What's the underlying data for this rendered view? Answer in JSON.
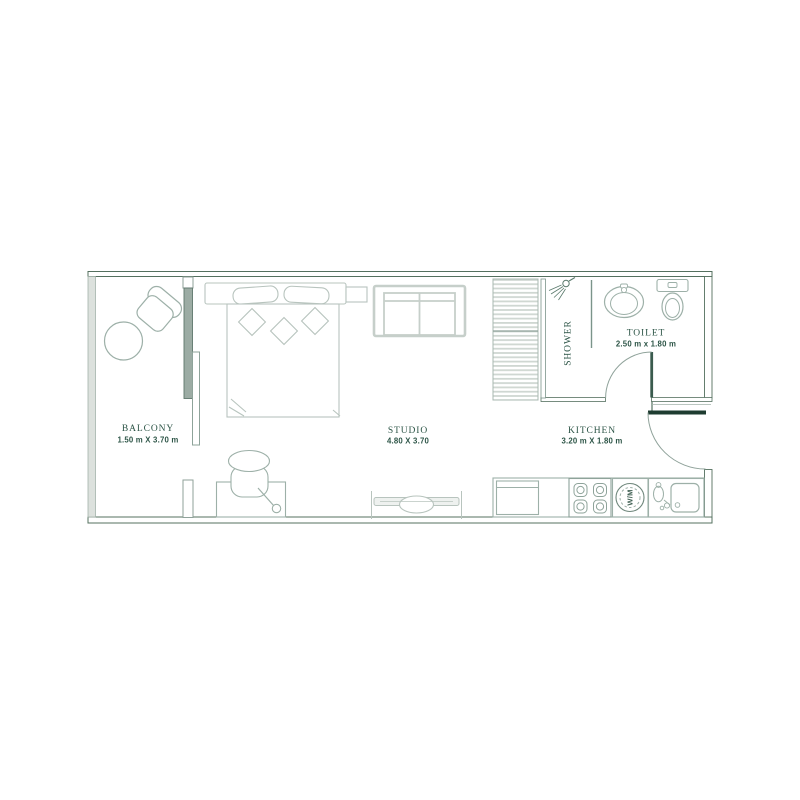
{
  "palette": {
    "wall_line": "#54705f",
    "wall_fill_light": "#dce1dd",
    "furniture_line_light": "#b8c4be",
    "furniture_line_mid": "#9db0a8",
    "door_leaf_dark": "#1e3c30",
    "text_green": "#2d5547"
  },
  "rooms": {
    "balcony": {
      "name": "BALCONY",
      "dimensions": "1.50 m X 3.70 m"
    },
    "studio": {
      "name": "STUDIO",
      "dimensions": "4.80 X 3.70"
    },
    "shower": {
      "name": "SHOWER"
    },
    "toilet": {
      "name": "TOILET",
      "dimensions": "2.50 m x 1.80 m"
    },
    "kitchen": {
      "name": "KITCHEN",
      "dimensions": "3.20 m X 1.80 m"
    }
  },
  "appliances": {
    "washing_machine_label": "W/M"
  },
  "icons": {
    "shower-head-icon": "shower sprayer glyph",
    "washbasin-icon": "oval basin with tap",
    "wc-toilet-icon": "toilet with cistern",
    "stove-icon": "4-burner hob",
    "washing-machine-icon": "drum circle",
    "kitchen-sink-icon": "sink basin with tap",
    "fridge-icon": "refrigerator box",
    "bed-icon": "double bed with pillows",
    "sofa-icon": "two-seat sofa",
    "tv-console-icon": "tv on stand",
    "lounge-chair-icon": "balcony armchair",
    "round-table-icon": "round balcony table",
    "desk-icon": "dressing table",
    "desk-chair-icon": "tub chair"
  }
}
